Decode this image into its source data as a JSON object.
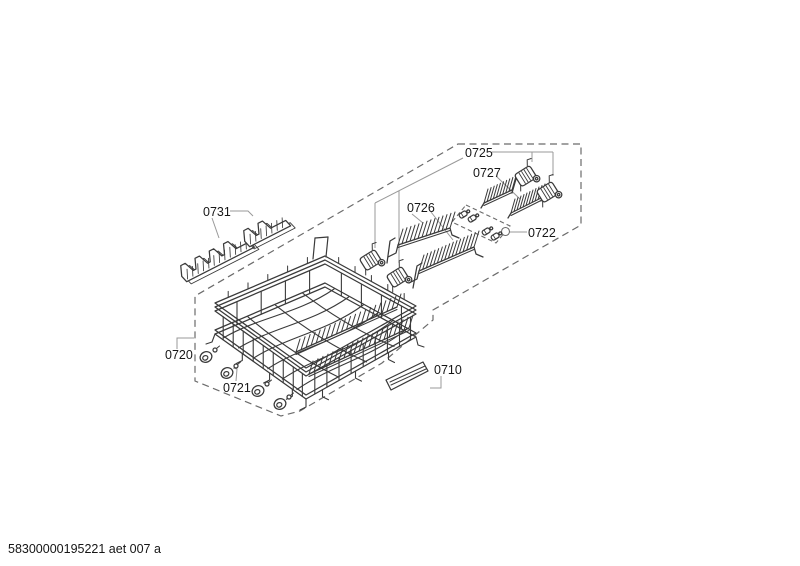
{
  "document": {
    "footer": "58300000195221 aet 007 a"
  },
  "labels": {
    "l0710": "0710",
    "l0720": "0720",
    "l0721": "0721",
    "l0722": "0722",
    "l0725": "0725",
    "l0726": "0726",
    "l0727": "0727",
    "l0731": "0731"
  },
  "colors": {
    "line": "#3a3a3a",
    "dashed": "#6b6b6b",
    "leader": "#999999",
    "text": "#161616",
    "background": "#ffffff"
  }
}
